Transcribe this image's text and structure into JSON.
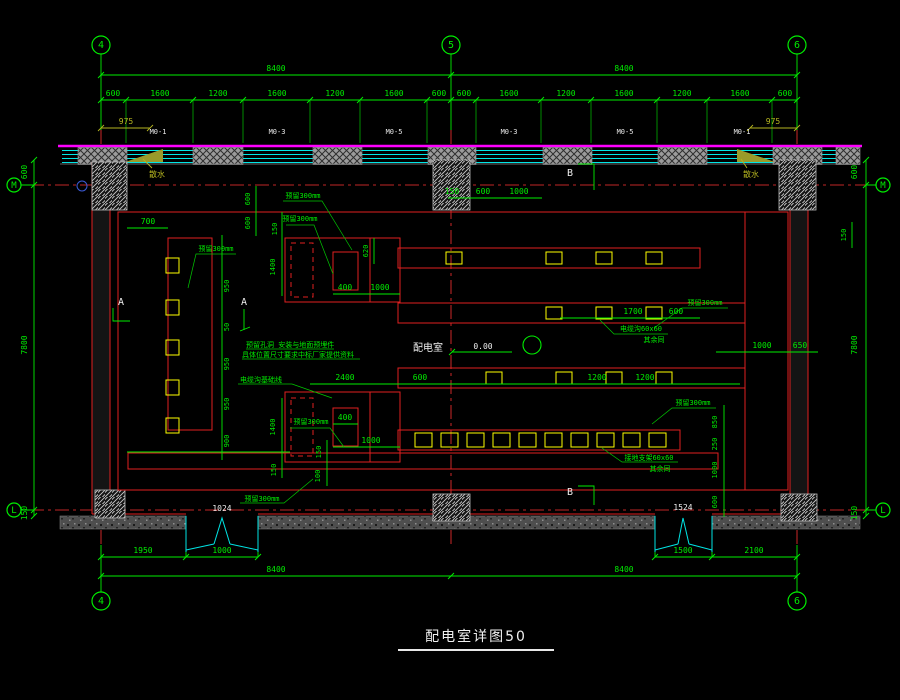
{
  "title": {
    "text": "配电室详图50"
  },
  "colors": {
    "background": "#000000",
    "dimension_green": "#00ee00",
    "wall_red": "#e02020",
    "axis_red": "#ff3333",
    "window_cyan": "#00e5e5",
    "magenta": "#ff00ff",
    "equipment_yellow": "#ffff00",
    "label_white": "#f0f0f0",
    "apron_olive": "#b5b520"
  },
  "grid": {
    "bubbles": [
      {
        "label": "4",
        "x": 101,
        "y": 45,
        "r": 9
      },
      {
        "label": "5",
        "x": 451,
        "y": 45,
        "r": 9
      },
      {
        "label": "6",
        "x": 797,
        "y": 45,
        "r": 9
      },
      {
        "label": "4",
        "x": 101,
        "y": 601,
        "r": 9
      },
      {
        "label": "6",
        "x": 797,
        "y": 601,
        "r": 9
      },
      {
        "label": "M",
        "x": 14,
        "y": 185,
        "r": 7
      },
      {
        "label": "L",
        "x": 14,
        "y": 510,
        "r": 7
      },
      {
        "label": "M",
        "x": 883,
        "y": 185,
        "r": 7
      },
      {
        "label": "L",
        "x": 883,
        "y": 510,
        "r": 7
      }
    ]
  },
  "annotations": [
    {
      "text": "8400",
      "x": 276,
      "y": 71
    },
    {
      "text": "8400",
      "x": 624,
      "y": 71
    },
    {
      "text": "600",
      "x": 113,
      "y": 96
    },
    {
      "text": "1600",
      "x": 160,
      "y": 96
    },
    {
      "text": "1200",
      "x": 218,
      "y": 96
    },
    {
      "text": "1600",
      "x": 277,
      "y": 96
    },
    {
      "text": "1200",
      "x": 335,
      "y": 96
    },
    {
      "text": "1600",
      "x": 394,
      "y": 96
    },
    {
      "text": "600",
      "x": 439,
      "y": 96
    },
    {
      "text": "600",
      "x": 464,
      "y": 96
    },
    {
      "text": "1600",
      "x": 509,
      "y": 96
    },
    {
      "text": "1200",
      "x": 566,
      "y": 96
    },
    {
      "text": "1600",
      "x": 624,
      "y": 96
    },
    {
      "text": "1200",
      "x": 682,
      "y": 96
    },
    {
      "text": "1600",
      "x": 740,
      "y": 96
    },
    {
      "text": "600",
      "x": 785,
      "y": 96
    },
    {
      "text": "975",
      "x": 126,
      "y": 124,
      "color": "#b5b520"
    },
    {
      "text": "975",
      "x": 773,
      "y": 124,
      "color": "#b5b520"
    },
    {
      "text": "M0-1",
      "x": 158,
      "y": 134,
      "color": "#e8e8e8",
      "size": 7,
      "name": "window-tag"
    },
    {
      "text": "M0-3",
      "x": 277,
      "y": 134,
      "color": "#e8e8e8",
      "size": 7,
      "name": "window-tag"
    },
    {
      "text": "M0-5",
      "x": 394,
      "y": 134,
      "color": "#e8e8e8",
      "size": 7,
      "name": "window-tag"
    },
    {
      "text": "M0-3",
      "x": 509,
      "y": 134,
      "color": "#e8e8e8",
      "size": 7,
      "name": "window-tag"
    },
    {
      "text": "M0-5",
      "x": 625,
      "y": 134,
      "color": "#e8e8e8",
      "size": 7,
      "name": "window-tag"
    },
    {
      "text": "M0-1",
      "x": 742,
      "y": 134,
      "color": "#e8e8e8",
      "size": 7,
      "name": "window-tag"
    },
    {
      "text": "散水",
      "x": 157,
      "y": 177,
      "color": "#b5b520",
      "size": 8,
      "name": "apron-label"
    },
    {
      "text": "散水",
      "x": 751,
      "y": 177,
      "color": "#b5b520",
      "size": 8,
      "name": "apron-label"
    },
    {
      "text": "600",
      "x": 27,
      "y": 172,
      "rot": -90
    },
    {
      "text": "7800",
      "x": 27,
      "y": 345,
      "rot": -90
    },
    {
      "text": "150",
      "x": 27,
      "y": 513,
      "rot": -90
    },
    {
      "text": "600",
      "x": 857,
      "y": 172,
      "rot": -90
    },
    {
      "text": "7800",
      "x": 857,
      "y": 345,
      "rot": -90
    },
    {
      "text": "150",
      "x": 857,
      "y": 513,
      "rot": -90
    },
    {
      "text": "A",
      "x": 121,
      "y": 305,
      "color": "#f0f0f0",
      "size": 10,
      "name": "section-marker-a"
    },
    {
      "text": "A",
      "x": 244,
      "y": 305,
      "color": "#f0f0f0",
      "size": 10,
      "name": "section-marker-a"
    },
    {
      "text": "B",
      "x": 570,
      "y": 176,
      "color": "#f0f0f0",
      "size": 10,
      "name": "section-marker-b"
    },
    {
      "text": "B",
      "x": 570,
      "y": 495,
      "color": "#f0f0f0",
      "size": 10,
      "name": "section-marker-b"
    },
    {
      "text": "配电室",
      "x": 428,
      "y": 351,
      "color": "#f0f0f0",
      "size": 10,
      "name": "room-label"
    },
    {
      "text": "0.00",
      "x": 483,
      "y": 349,
      "color": "#f0f0f0",
      "size": 8,
      "name": "level-label"
    },
    {
      "text": "预留300mm",
      "x": 303,
      "y": 198,
      "size": 7
    },
    {
      "text": "预留300mm",
      "x": 300,
      "y": 221,
      "size": 7
    },
    {
      "text": "600",
      "x": 250,
      "y": 199,
      "rot": -90,
      "size": 7
    },
    {
      "text": "600",
      "x": 250,
      "y": 223,
      "rot": -90,
      "size": 7
    },
    {
      "text": "150",
      "x": 277,
      "y": 229,
      "rot": -90,
      "size": 7
    },
    {
      "text": "1400",
      "x": 275,
      "y": 267,
      "rot": -90,
      "size": 7
    },
    {
      "text": "620",
      "x": 368,
      "y": 251,
      "rot": -90,
      "size": 7
    },
    {
      "text": "400",
      "x": 345,
      "y": 290
    },
    {
      "text": "1000",
      "x": 380,
      "y": 290
    },
    {
      "text": "150",
      "x": 452,
      "y": 194
    },
    {
      "text": "600",
      "x": 483,
      "y": 194
    },
    {
      "text": "1000",
      "x": 519,
      "y": 194
    },
    {
      "text": "150",
      "x": 846,
      "y": 235,
      "rot": -90,
      "size": 7
    },
    {
      "text": "700",
      "x": 148,
      "y": 224
    },
    {
      "text": "预留300mm",
      "x": 216,
      "y": 251,
      "size": 7
    },
    {
      "text": "950",
      "x": 229,
      "y": 286,
      "rot": -90,
      "size": 7
    },
    {
      "text": "50",
      "x": 229,
      "y": 327,
      "rot": -90,
      "size": 7
    },
    {
      "text": "950",
      "x": 229,
      "y": 364,
      "rot": -90,
      "size": 7
    },
    {
      "text": "950",
      "x": 229,
      "y": 404,
      "rot": -90,
      "size": 7
    },
    {
      "text": "900",
      "x": 229,
      "y": 441,
      "rot": -90,
      "size": 7
    },
    {
      "text": "预留孔洞 安装与地面预埋件",
      "x": 246,
      "y": 347,
      "anchor": "start",
      "size": 7,
      "name": "note-line"
    },
    {
      "text": "具体位置尺寸要求中标厂家提供资料",
      "x": 242,
      "y": 357,
      "anchor": "start",
      "size": 7,
      "name": "note-line"
    },
    {
      "text": "电缆沟基础线",
      "x": 240,
      "y": 382,
      "anchor": "start",
      "size": 7,
      "name": "note-label"
    },
    {
      "text": "2400",
      "x": 345,
      "y": 380
    },
    {
      "text": "600",
      "x": 420,
      "y": 380
    },
    {
      "text": "1200",
      "x": 597,
      "y": 380
    },
    {
      "text": "1200",
      "x": 645,
      "y": 380
    },
    {
      "text": "1700",
      "x": 633,
      "y": 314
    },
    {
      "text": "600",
      "x": 676,
      "y": 314
    },
    {
      "text": "预留300mm",
      "x": 705,
      "y": 305,
      "size": 7
    },
    {
      "text": "电缆沟60x60",
      "x": 641,
      "y": 331,
      "size": 7
    },
    {
      "text": "其余同",
      "x": 654,
      "y": 342,
      "size": 7
    },
    {
      "text": "1000",
      "x": 762,
      "y": 348
    },
    {
      "text": "650",
      "x": 800,
      "y": 348
    },
    {
      "text": "预留300mm",
      "x": 311,
      "y": 424,
      "size": 7
    },
    {
      "text": "400",
      "x": 345,
      "y": 420
    },
    {
      "text": "1000",
      "x": 371,
      "y": 443
    },
    {
      "text": "1400",
      "x": 275,
      "y": 427,
      "rot": -90,
      "size": 7
    },
    {
      "text": "150",
      "x": 276,
      "y": 470,
      "rot": -90,
      "size": 7
    },
    {
      "text": "150",
      "x": 321,
      "y": 452,
      "rot": -90,
      "size": 7
    },
    {
      "text": "100",
      "x": 320,
      "y": 476,
      "rot": -90,
      "size": 7
    },
    {
      "text": "预留300mm",
      "x": 693,
      "y": 405,
      "size": 7
    },
    {
      "text": "850",
      "x": 717,
      "y": 422,
      "rot": -90,
      "size": 7
    },
    {
      "text": "250",
      "x": 717,
      "y": 444,
      "rot": -90,
      "size": 7
    },
    {
      "text": "1000",
      "x": 717,
      "y": 470,
      "rot": -90,
      "size": 7
    },
    {
      "text": "600",
      "x": 717,
      "y": 502,
      "rot": -90,
      "size": 7
    },
    {
      "text": "接地支架60x60",
      "x": 649,
      "y": 460,
      "size": 7
    },
    {
      "text": "其余同",
      "x": 660,
      "y": 471,
      "size": 7
    },
    {
      "text": "预留300mm",
      "x": 262,
      "y": 501,
      "size": 7
    },
    {
      "text": "1024",
      "x": 222,
      "y": 511,
      "color": "#f0f0f0",
      "size": 8,
      "name": "door-tag"
    },
    {
      "text": "1524",
      "x": 683,
      "y": 510,
      "color": "#f0f0f0",
      "size": 8,
      "name": "door-tag"
    },
    {
      "text": "1950",
      "x": 143,
      "y": 553
    },
    {
      "text": "1000",
      "x": 222,
      "y": 553
    },
    {
      "text": "1500",
      "x": 683,
      "y": 553
    },
    {
      "text": "2100",
      "x": 754,
      "y": 553
    },
    {
      "text": "8400",
      "x": 276,
      "y": 572
    },
    {
      "text": "8400",
      "x": 624,
      "y": 572
    }
  ]
}
